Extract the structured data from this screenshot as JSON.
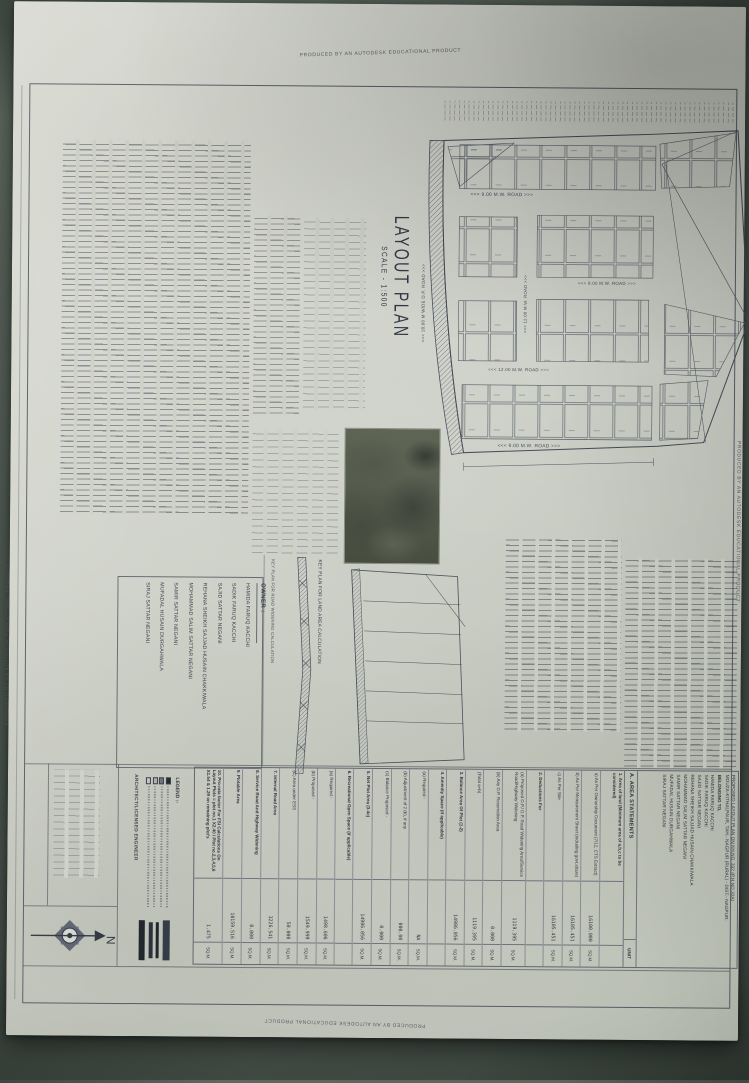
{
  "watermark": {
    "text": "PRODUCED BY AN AUTODESK EDUCATIONAL PRODUCT"
  },
  "titleblock": {
    "title": "LAYOUT PLAN",
    "scale": "SCALE - 1:500"
  },
  "plan": {
    "road_label_9m": "<<< 9.00 M.W. ROAD >>>",
    "road_label_12m": "<<< 12.00 M.W. ROAD >>>",
    "road_label_dp": "<<< 18.00 M WIDE D.P. ROAD >>>"
  },
  "keyplans": {
    "land_label": "KEY PLAN FOR LAND AREA CALCULATION",
    "road_label": "KEY PLAN FOR ROAD WIDENING CALCULATION"
  },
  "owner": {
    "heading": "OWNER :",
    "names": [
      "HAMIDA FARUQ KACCHI",
      "SADIK FARUQ KACCHI",
      "SAJID SATTAR NEGANI",
      "REHANA SHEIKH SAJJAD HUSAIN CHAKKIWALA",
      "MOHAMMAD SALIM SATTAR NEGANI",
      "SAMIR SATTAR NEGANI",
      "MUFADAL HUSAIN DURGAHWALA",
      "SIRAJ SATTAR NEGANI"
    ]
  },
  "area_statements": {
    "project_line1": "PROPOSED LAYOUT PLAN ON KH.NO. 332 (P.H.NO.32A)",
    "project_line2": "MOUZA-KITHALPAUR, TAH.- NAGPUR (RURAL) - DIST.- NAGPUR.",
    "belonging_label": "BELONGING TO,",
    "heading": "A. AREA STATEMENTS",
    "unit_heading": "UNIT",
    "rows": [
      {
        "kind": "section",
        "label": "1. Area of land (Minimum area of a,b,c to be considered)",
        "value": "",
        "unit": ""
      },
      {
        "kind": "item",
        "label": "a) As Per Ownership Document (7/12, CTS Extract)",
        "value": "16100.000",
        "unit": "SQ.M."
      },
      {
        "kind": "item",
        "label": "b) As Per Measurement Sheet (including govt.share)",
        "value": "16105.451",
        "unit": "SQ.M."
      },
      {
        "kind": "item",
        "label": "c) As Per Site",
        "value": "16105.451",
        "unit": "SQ.M."
      },
      {
        "kind": "section",
        "label": "2. Deductions For",
        "value": "",
        "unit": ""
      },
      {
        "kind": "item",
        "label": "(a) Proposed D.P./ D.P. Road Widening Area/Service Road/Highway Widening",
        "value": "1119.395",
        "unit": "SQ.M."
      },
      {
        "kind": "item",
        "label": "(b) Any D.P. Reservation Area",
        "value": "0.000",
        "unit": "SQ.M."
      },
      {
        "kind": "item",
        "label": "(Total a+b)",
        "value": "1119.395",
        "unit": "SQ.M."
      },
      {
        "kind": "section",
        "label": "3. Balance Area Of Plot (1-2)",
        "value": "14986.056",
        "unit": "SQ.M."
      },
      {
        "kind": "section",
        "label": "4. Amenity Space (if applicable)",
        "value": "",
        "unit": ""
      },
      {
        "kind": "item",
        "label": "(a) Required -",
        "value": "NA",
        "unit": "SQ.M."
      },
      {
        "kind": "item",
        "label": "(b) Adjustment of 2 (b), if any",
        "value": "000.00",
        "unit": "SQ.M."
      },
      {
        "kind": "item",
        "label": "(c) Balance Proposed -",
        "value": "0.000",
        "unit": "SQ.M."
      },
      {
        "kind": "section",
        "label": "5. Net Plot Area (3-4c)",
        "value": "14986.056",
        "unit": "SQ.M."
      },
      {
        "kind": "section",
        "label": "6. Recreational Open Space (if applicable)",
        "value": "",
        "unit": ""
      },
      {
        "kind": "item",
        "label": "(a) Required -",
        "value": "1498.606",
        "unit": "SQ.M."
      },
      {
        "kind": "item",
        "label": "(b) Proposed -",
        "value": "1549.999",
        "unit": "SQ.M."
      },
      {
        "kind": "item",
        "label": "(C) Area under ESS",
        "value": "50.000",
        "unit": "SQ.M."
      },
      {
        "kind": "section",
        "label": "7. Internal Road Area",
        "value": "3226.541",
        "unit": "SQ.M."
      },
      {
        "kind": "section",
        "label": "8. Service Road And Highway Widening",
        "value": "0.000",
        "unit": "SQ.M."
      },
      {
        "kind": "section",
        "label": "9. Plotable Area",
        "value": "10159.516",
        "unit": "SQ.M."
      },
      {
        "kind": "section",
        "label": "10. Pro-rata factor For FSI Calculations On Layout Plots = plot no.1 X2.40 / Plot no.2,3,4,5,6 X1.54 & 1.29 on remaining plot's",
        "value": "1.475",
        "unit": "SQ.M."
      }
    ]
  },
  "legend": {
    "heading": "LEGEND :-"
  },
  "architect_label": "ARCHITECT/LICENSED ENGINEER",
  "compass": {
    "north": "N"
  }
}
